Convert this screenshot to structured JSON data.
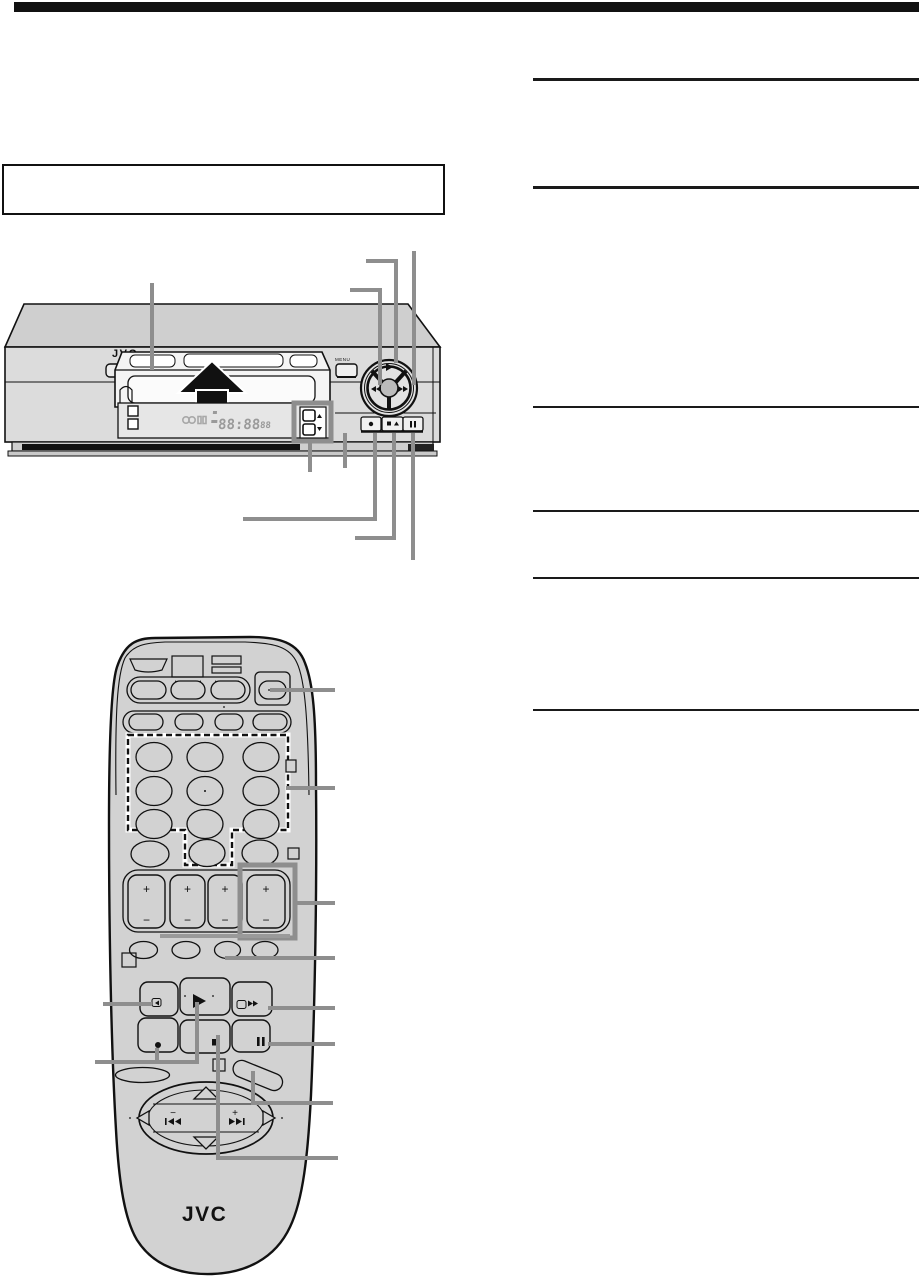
{
  "document": {
    "type": "vcr-instruction-manual-page",
    "header_bar_color": "#111111",
    "callout_line_color": "#8e8e8e",
    "figure_body_color": "#d2d2d2",
    "display_segment_color": "#9a9a9a"
  },
  "vcr": {
    "brand_logo": "JVC",
    "menu_button_label": "MENU",
    "display": {
      "clock": "88:88",
      "counter": "88"
    },
    "icons": {
      "eject_arrow": "up-arrow",
      "channel_up": "triangle-up",
      "channel_down": "triangle-down",
      "dial_play": "play-triangle",
      "dial_rewind": "double-left-triangles",
      "dial_fast_forward": "double-right-triangles",
      "record": "dot",
      "stop_eject": "square-slash-triangle",
      "pause": "double-bars"
    }
  },
  "remote": {
    "brand_logo": "JVC",
    "rocker_plus_label": "+",
    "rocker_minus_label": "−",
    "pad_minus_label": "−",
    "pad_plus_label": "+",
    "icons": {
      "play": "play-triangle",
      "stop": "filled-square",
      "record": "dot",
      "pause": "double-bars",
      "rewind": "double-left-triangles",
      "fast_forward": "double-right-triangles",
      "pad_up": "triangle-up-outline",
      "pad_down": "triangle-down-outline",
      "pad_left": "triangle-left-outline",
      "pad_right": "triangle-right-outline"
    }
  }
}
